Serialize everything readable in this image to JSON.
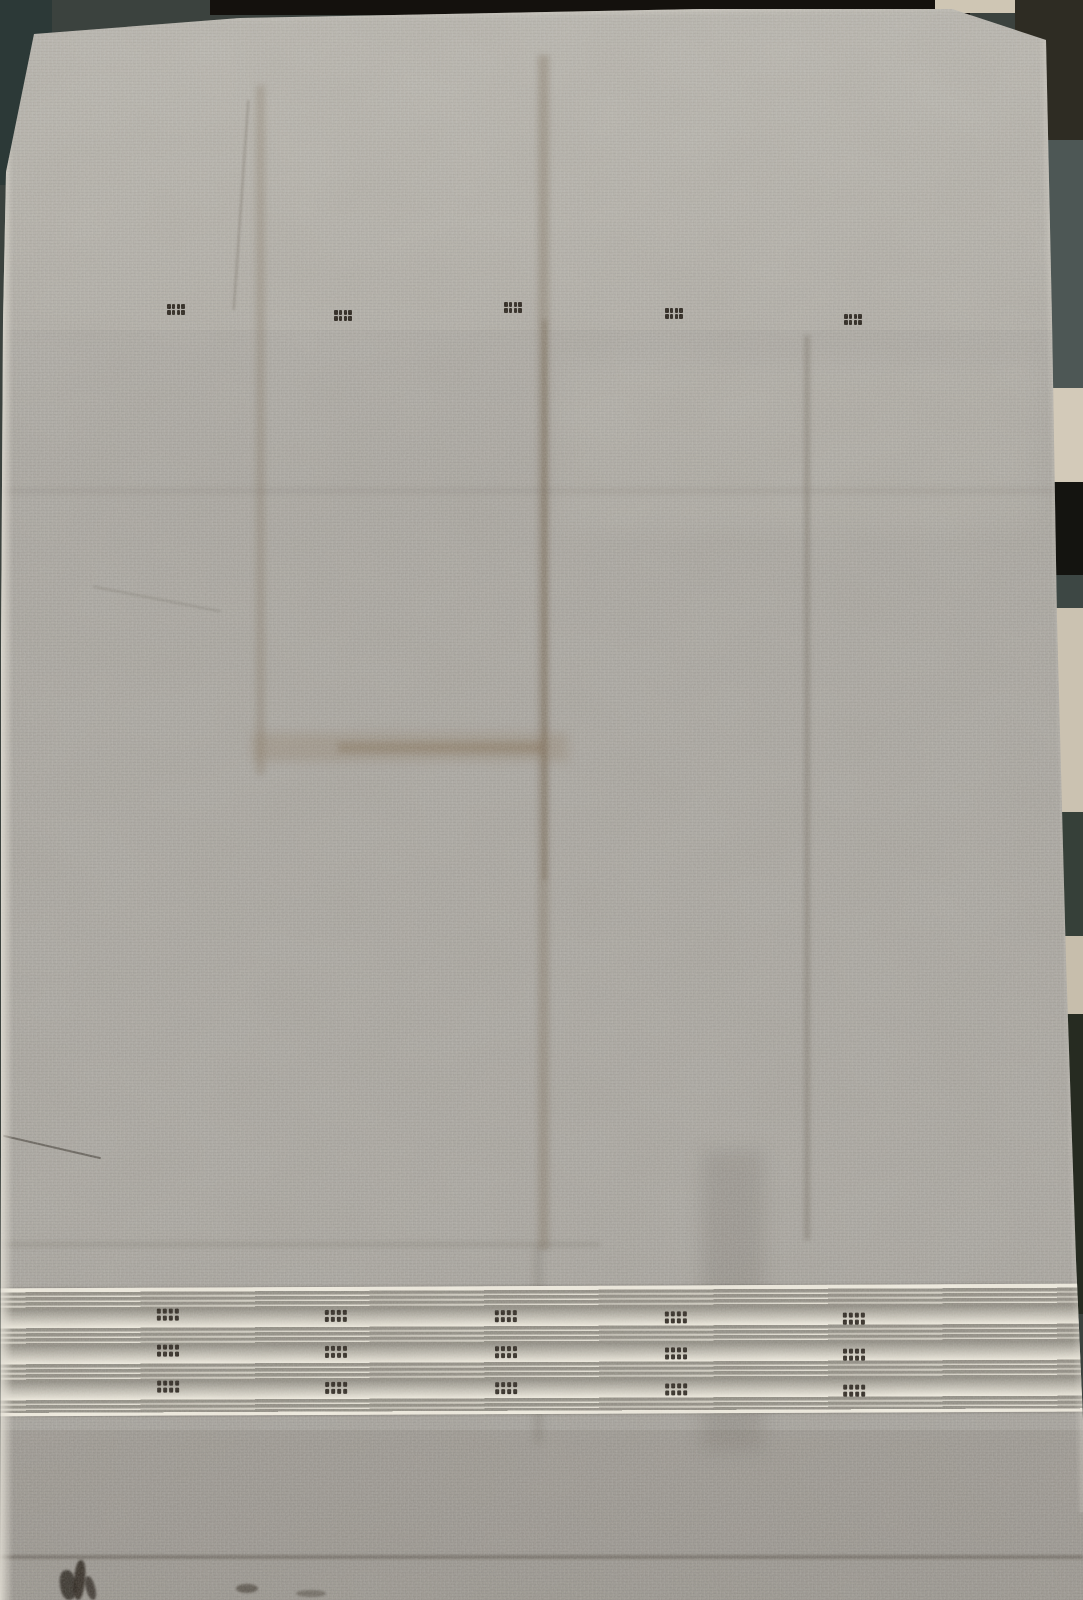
{
  "scene": {
    "description": "Photograph of a plain gray handwoven khadi fabric laid flat on a dark patterned floor, with five small dark woven buti motifs in a row near the top and a cream striped border band with three rows of dotted motifs near the bottom",
    "canvas": {
      "width": 1083,
      "height": 1600
    }
  },
  "colors": {
    "backdrop": "#3b423e",
    "fabric_hi": "#b2afa9",
    "fabric_mid": "#a7a49e",
    "fabric_lo": "#a09d97",
    "selvedge": "rgba(228,224,214,0.85)",
    "border_cream": "#efebdf",
    "border_stripe": "#8e8b82",
    "motif_dark": "#29231c"
  },
  "backdrop": {
    "patches": [
      {
        "name": "bg-teal-top-left",
        "x": 0,
        "y": 0,
        "w": 52,
        "h": 185,
        "c": "#2c3937",
        "r": "0 0 45% 0"
      },
      {
        "name": "bg-dark-top-strip",
        "x": 210,
        "y": 0,
        "w": 760,
        "h": 15,
        "c": "#14110d",
        "r": "0"
      },
      {
        "name": "bg-beige-top-right",
        "x": 935,
        "y": 0,
        "w": 105,
        "h": 13,
        "c": "#cfc6b4",
        "r": "0"
      },
      {
        "name": "bg-olive-top-right",
        "x": 1015,
        "y": 0,
        "w": 68,
        "h": 145,
        "c": "#2e2c23",
        "r": "0"
      },
      {
        "name": "bg-slate-right-1",
        "x": 1038,
        "y": 140,
        "w": 45,
        "h": 260,
        "c": "#4d5755",
        "r": "0"
      },
      {
        "name": "bg-beige-right-1",
        "x": 1042,
        "y": 388,
        "w": 41,
        "h": 100,
        "c": "#d3cab9",
        "r": "0"
      },
      {
        "name": "bg-black-right",
        "x": 1045,
        "y": 482,
        "w": 38,
        "h": 98,
        "c": "#141410",
        "r": "0"
      },
      {
        "name": "bg-slate-right-2",
        "x": 1047,
        "y": 575,
        "w": 36,
        "h": 38,
        "c": "#3d4744",
        "r": "0"
      },
      {
        "name": "bg-beige-right-2",
        "x": 1049,
        "y": 608,
        "w": 34,
        "h": 208,
        "c": "#cbc2b1",
        "r": "0"
      },
      {
        "name": "bg-green-right",
        "x": 1052,
        "y": 812,
        "w": 31,
        "h": 128,
        "c": "#364039",
        "r": "0"
      },
      {
        "name": "bg-beige-right-3",
        "x": 1055,
        "y": 936,
        "w": 28,
        "h": 82,
        "c": "#c7beac",
        "r": "0"
      },
      {
        "name": "bg-dark-right-bottom",
        "x": 1058,
        "y": 1014,
        "w": 25,
        "h": 300,
        "c": "#262b21",
        "r": "0"
      }
    ]
  },
  "fabric": {
    "clip": [
      [
        34,
        34
      ],
      [
        240,
        18
      ],
      [
        700,
        9
      ],
      [
        952,
        9
      ],
      [
        1046,
        40
      ],
      [
        1052,
        320
      ],
      [
        1057,
        620
      ],
      [
        1066,
        960
      ],
      [
        1076,
        1260
      ],
      [
        1083,
        1420
      ],
      [
        1083,
        1600
      ],
      [
        0,
        1600
      ],
      [
        1,
        1150
      ],
      [
        1,
        650
      ],
      [
        3,
        320
      ],
      [
        6,
        172
      ]
    ],
    "overlays": [
      {
        "name": "light-top",
        "x": 0,
        "y": 0,
        "w": 1083,
        "h": 330,
        "c": "rgba(255,252,244,0.05)"
      },
      {
        "name": "light-right-center",
        "x": 560,
        "y": 360,
        "w": 480,
        "h": 170,
        "c": "rgba(255,252,244,0.05)",
        "bl": 12
      },
      {
        "name": "crease-vertical-left",
        "x": 256,
        "y": 85,
        "w": 9,
        "h": 690,
        "c": "rgba(116,99,78,0.26)",
        "bl": 3
      },
      {
        "name": "crease-vertical-center",
        "x": 538,
        "y": 55,
        "w": 11,
        "h": 1195,
        "c": "rgba(113,96,74,0.32)",
        "bl": 3
      },
      {
        "name": "crease-vertical-center-core",
        "x": 542,
        "y": 320,
        "w": 5,
        "h": 560,
        "c": "rgba(96,78,56,0.30)",
        "bl": 2
      },
      {
        "name": "crease-vertical-right",
        "x": 804,
        "y": 335,
        "w": 6,
        "h": 905,
        "c": "rgba(88,79,64,0.28)",
        "bl": 2
      },
      {
        "name": "smudge-horizontal",
        "x": 252,
        "y": 733,
        "w": 316,
        "h": 28,
        "c": "rgba(130,108,80,0.26)",
        "bl": 5
      },
      {
        "name": "smudge-horizontal-core",
        "x": 338,
        "y": 742,
        "w": 205,
        "h": 11,
        "c": "rgba(116,92,64,0.30)",
        "bl": 3
      },
      {
        "name": "crease-horizontal-mid",
        "x": 0,
        "y": 488,
        "w": 1083,
        "h": 6,
        "c": "rgba(95,90,78,0.10)",
        "bl": 2
      },
      {
        "name": "crease-above-border",
        "x": 0,
        "y": 1242,
        "w": 600,
        "h": 5,
        "c": "rgba(85,79,68,0.16)",
        "bl": 2
      },
      {
        "name": "fold-shadow-border",
        "x": 702,
        "y": 1150,
        "w": 62,
        "h": 300,
        "c": "rgba(62,57,49,0.13)",
        "bl": 9
      },
      {
        "name": "crease-through-border",
        "x": 534,
        "y": 1248,
        "w": 9,
        "h": 195,
        "c": "rgba(74,67,56,0.16)",
        "bl": 4
      },
      {
        "name": "shade-bottom",
        "x": 0,
        "y": 1430,
        "w": 1083,
        "h": 170,
        "c": "rgba(76,71,63,0.10)"
      },
      {
        "name": "fold-crease-bottom",
        "x": 0,
        "y": 1555,
        "w": 1083,
        "h": 4,
        "c": "rgba(62,56,47,0.38)",
        "bl": 1
      },
      {
        "name": "thread-bottom-left",
        "x": 2,
        "y": 1146,
        "w": 100,
        "h": 2,
        "c": "rgba(48,42,34,0.55)",
        "rot": 13
      },
      {
        "name": "thread-top-left",
        "x": 240,
        "y": 100,
        "w": 2,
        "h": 210,
        "c": "rgba(75,66,54,0.30)",
        "bl": 1,
        "rot": 4
      },
      {
        "name": "thread-mid-left",
        "x": 92,
        "y": 598,
        "w": 130,
        "h": 2,
        "c": "rgba(84,75,62,0.25)",
        "bl": 1,
        "rot": 11
      },
      {
        "name": "ink-blotch-1",
        "x": 60,
        "y": 1570,
        "w": 16,
        "h": 30,
        "c": "rgba(28,22,16,0.80)",
        "bl": 1,
        "r": "45%",
        "rot": -8
      },
      {
        "name": "ink-blotch-2",
        "x": 74,
        "y": 1560,
        "w": 11,
        "h": 40,
        "c": "rgba(30,24,17,0.85)",
        "bl": 1,
        "r": "45%",
        "rot": 5
      },
      {
        "name": "ink-blotch-3",
        "x": 86,
        "y": 1576,
        "w": 9,
        "h": 24,
        "c": "rgba(28,22,16,0.75)",
        "bl": 1,
        "r": "45%",
        "rot": -15
      },
      {
        "name": "ink-spur-1",
        "x": 236,
        "y": 1584,
        "w": 22,
        "h": 9,
        "c": "rgba(40,33,24,0.55)",
        "bl": 1,
        "r": "50%"
      },
      {
        "name": "ink-spur-2",
        "x": 296,
        "y": 1590,
        "w": 30,
        "h": 7,
        "c": "rgba(50,43,33,0.40)",
        "bl": 1,
        "r": "50%"
      }
    ],
    "top_motifs": {
      "dot": {
        "w": 3.4,
        "h": 4.8,
        "gx": 1.3,
        "gy": 1.2,
        "c": "#221c15"
      },
      "items": [
        {
          "x": 176,
          "y": 304
        },
        {
          "x": 343,
          "y": 310
        },
        {
          "x": 513,
          "y": 302
        },
        {
          "x": 674,
          "y": 308
        },
        {
          "x": 853,
          "y": 314
        }
      ]
    },
    "border": {
      "top": 1286,
      "height": 128,
      "tilt_deg": -0.25,
      "cream": "#efebdf",
      "stripe": "#8e8b82",
      "stripe_h": 2.6,
      "stripe_offsets": [
        4,
        9,
        14,
        19,
        40,
        45,
        50,
        55,
        76,
        81,
        86,
        91,
        112,
        117,
        122
      ],
      "motif_row_tops": [
        24,
        60,
        96
      ],
      "columns": [
        {
          "x": 168,
          "dy": -3
        },
        {
          "x": 336,
          "dy": -1
        },
        {
          "x": 506,
          "dy": 0
        },
        {
          "x": 676,
          "dy": 2
        },
        {
          "x": 854,
          "dy": 4
        }
      ],
      "dot": {
        "w": 4.2,
        "h": 5,
        "gx": 1.7,
        "gy": 2,
        "c": "#29231c"
      }
    }
  }
}
